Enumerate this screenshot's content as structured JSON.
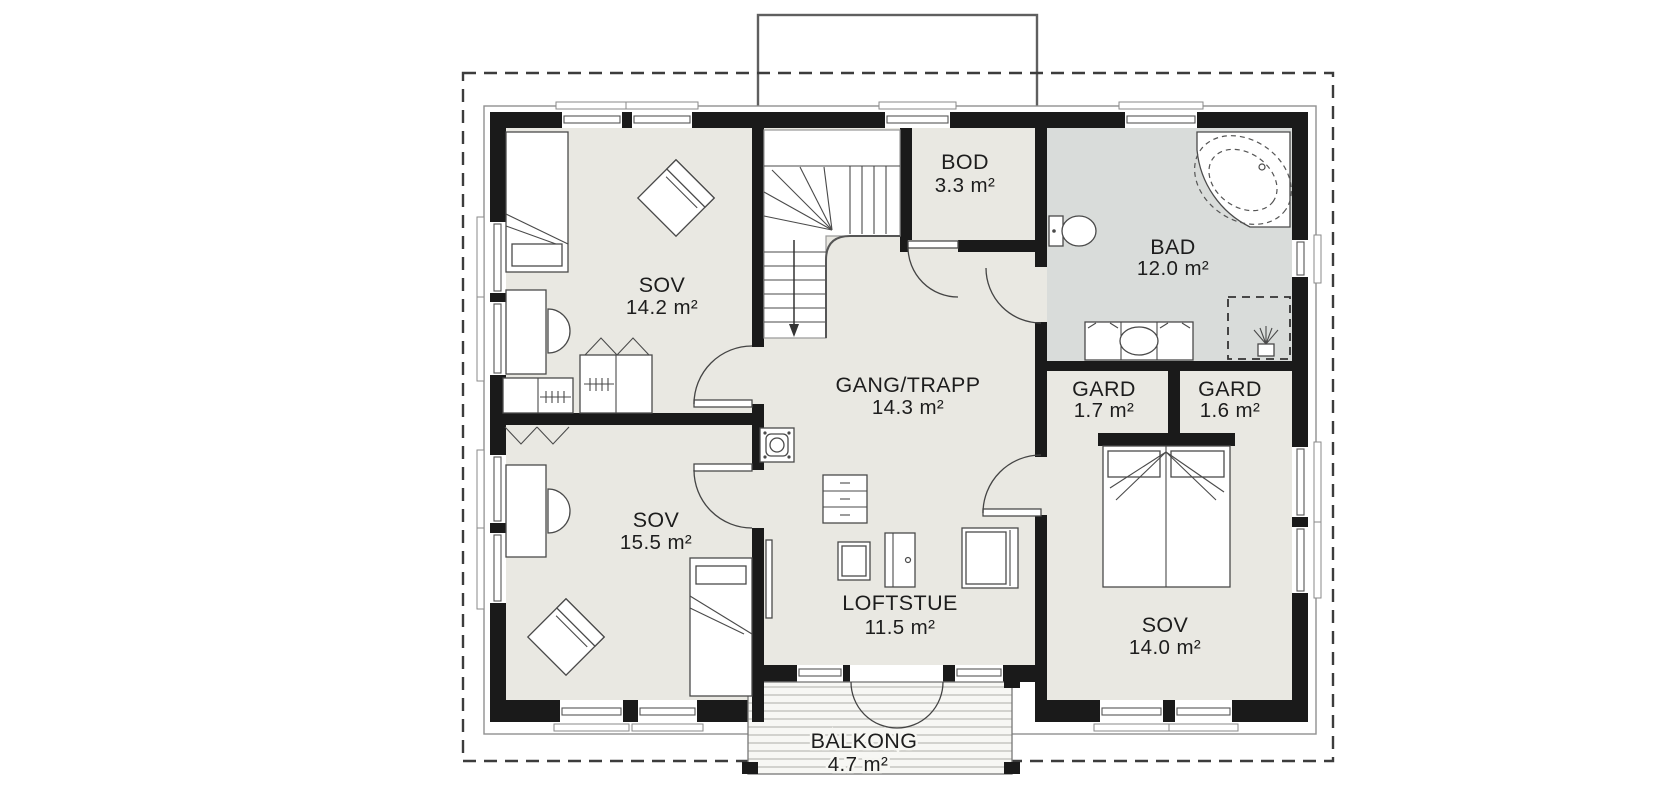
{
  "page": {
    "background": "#ffffff"
  },
  "plan": {
    "kind": "second-floor house plan",
    "colors": {
      "floor": "#e9e8e2",
      "bath_floor": "#d9dcda",
      "wall": "#1a1a1a",
      "text": "#1d1d1d",
      "furniture_line": "#4a4a4a",
      "deck": "#f7f7f4",
      "deck_stripe": "#c3c3bd"
    },
    "rooms": [
      {
        "id": "sov-north-west",
        "name": "SOV",
        "area": "14.2 m²"
      },
      {
        "id": "sov-south-west",
        "name": "SOV",
        "area": "15.5 m²"
      },
      {
        "id": "gang-trapp",
        "name": "GANG/TRAPP",
        "area": "14.3 m²"
      },
      {
        "id": "loftstue",
        "name": "LOFTSTUE",
        "area": "11.5 m²"
      },
      {
        "id": "bod",
        "name": "BOD",
        "area": "3.3 m²"
      },
      {
        "id": "bad",
        "name": "BAD",
        "area": "12.0 m²"
      },
      {
        "id": "gard-west",
        "name": "GARD",
        "area": "1.7 m²"
      },
      {
        "id": "gard-east",
        "name": "GARD",
        "area": "1.6 m²"
      },
      {
        "id": "sov-east",
        "name": "SOV",
        "area": "14.0 m²"
      },
      {
        "id": "balkong",
        "name": "BALKONG",
        "area": "4.7 m²"
      }
    ]
  }
}
